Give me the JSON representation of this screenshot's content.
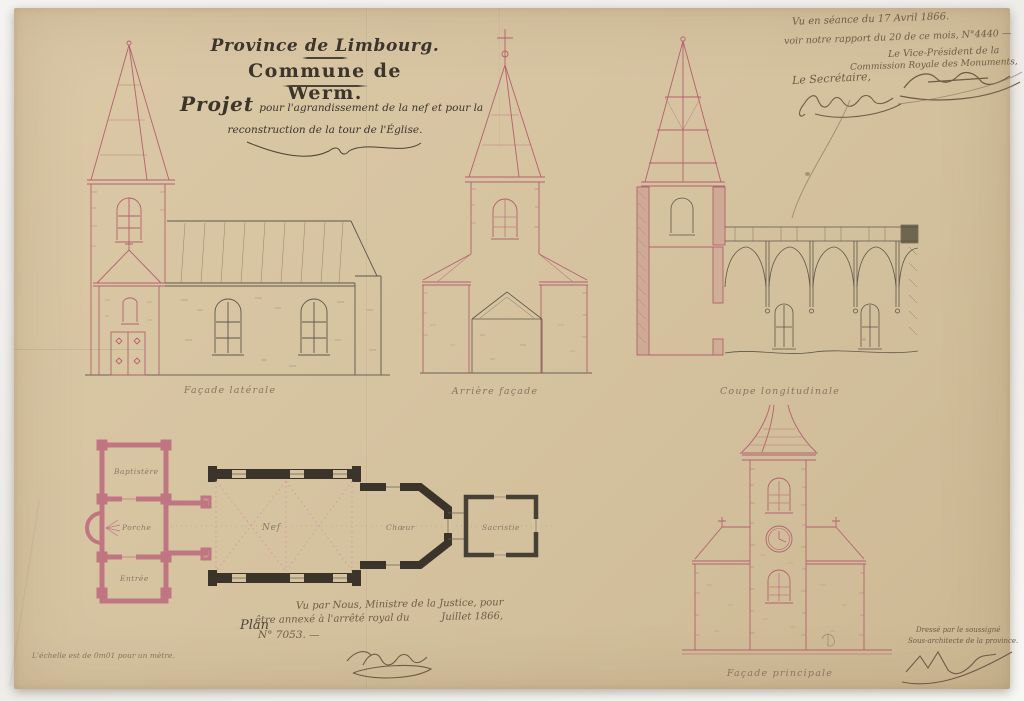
{
  "colors": {
    "paper": "#d6c3a0",
    "ink_dark": "#3b352c",
    "ink_sepia": "#6f5c46",
    "ink_pale": "#87755f",
    "red_ink": "#b4606e",
    "wall_black": "#3a342b"
  },
  "title_block": {
    "province": "Province de Limbourg.",
    "commune": "Commune de Werm.",
    "project_lead": "Projet",
    "project_rest": "pour l'agrandissement de la nef et pour la",
    "project_line2": "reconstruction de la tour de l'Église."
  },
  "approval_note": {
    "line1": "Vu en séance du 17 Avril 1866.",
    "line2": "voir notre rapport du 20 de ce mois, N°4440 —",
    "line3": "Le Vice-Président de la",
    "line4": "Commission Royale des Monuments,",
    "secretary_label": "Le Secrétaire,"
  },
  "drawings": {
    "facade_laterale": {
      "caption": "Façade latérale"
    },
    "arriere_facade": {
      "caption": "Arrière façade"
    },
    "coupe_longitudinale": {
      "caption": "Coupe longitudinale"
    },
    "facade_principale": {
      "caption": "Façade principale"
    },
    "plan": {
      "label": "Plan",
      "rooms": {
        "baptistere": "Baptistère",
        "porche": "Porche",
        "entree": "Entrée",
        "nef": "Nef",
        "choeur": "Chœur",
        "sacristie": "Sacristie"
      }
    }
  },
  "minister_note": {
    "line1": "Vu par Nous, Ministre de la Justice, pour",
    "line2": "être annexé à l'arrêté royal du          Juillet 1866,",
    "line3": "N° 7053. —"
  },
  "scale_note": "L'échelle est de 0m01 pour un mètre.",
  "draftsman_note": {
    "line1": "Dressé par le soussigné",
    "line2": "Sous-architecte de la province."
  }
}
